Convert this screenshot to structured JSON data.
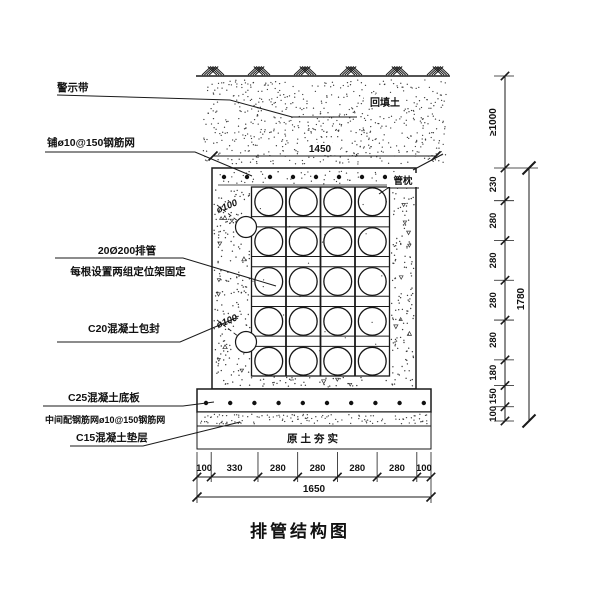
{
  "title": "排管结构图",
  "annotations": {
    "warning_tape": "警示带",
    "top_mesh": "铺ø10@150钢筋网",
    "pipes_line1": "20Ø200排管",
    "pipes_line2": "每根设置两组定位架固定",
    "encasement": "C20混凝土包封",
    "base_slab_line1": "C25混凝土底板",
    "base_slab_line2": "中间配钢筋网ø10@150钢筋网",
    "cushion": "C15混凝土垫层",
    "backfill": "回填土",
    "pipe_pillow": "管枕",
    "compacted_soil": "原土夯实",
    "pipe_hole_diameter": "ø100"
  },
  "dimensions": {
    "top_width": "1450",
    "bottom_segments": [
      "100",
      "330",
      "280",
      "280",
      "280",
      "280",
      "100"
    ],
    "bottom_total": "1650",
    "right_cover": "≥1000",
    "right_segments": [
      "230",
      "280",
      "280",
      "280",
      "280",
      "180",
      "150",
      "100"
    ],
    "right_total": "1780"
  },
  "structure": {
    "pipe_rows": 5,
    "pipe_cols": 4,
    "pipe_count": 20
  },
  "colors": {
    "line": "#1a1a1a",
    "text": "#111111",
    "background": "#ffffff"
  }
}
